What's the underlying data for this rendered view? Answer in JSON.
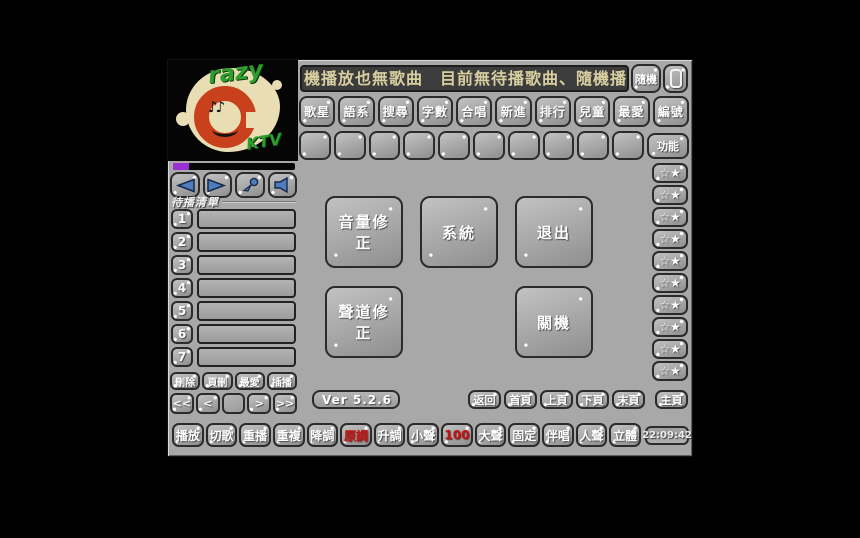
{
  "app": {
    "name": "Crazy KTV",
    "version_label": "Ver 5.2.6",
    "clock": "22:09:42"
  },
  "logo": {
    "razy": "razy",
    "ktv": "KTV",
    "notes": "♪♪"
  },
  "marquee": {
    "text": "機播放也無歌曲　目前無待播歌曲、隨機播放也無歌",
    "random_label": "隨機"
  },
  "category_buttons": [
    "歌星",
    "語系",
    "搜尋",
    "字數",
    "合唱",
    "新進",
    "排行",
    "兒童",
    "最愛",
    "編號"
  ],
  "quick_slots": {
    "function_label": "功能"
  },
  "playlist": {
    "title": "待播清單",
    "rows": [
      {
        "num": "1",
        "song": ""
      },
      {
        "num": "2",
        "song": ""
      },
      {
        "num": "3",
        "song": ""
      },
      {
        "num": "4",
        "song": ""
      },
      {
        "num": "5",
        "song": ""
      },
      {
        "num": "6",
        "song": ""
      },
      {
        "num": "7",
        "song": ""
      }
    ],
    "actions": [
      "刪除",
      "頁刪",
      "最愛",
      "插播"
    ],
    "pager": [
      "<<",
      "<",
      "",
      ">",
      ">>"
    ]
  },
  "center_buttons": [
    {
      "label": "音量修正"
    },
    {
      "label": "系統"
    },
    {
      "label": "退出"
    },
    {
      "label": "聲道修正"
    },
    {
      "label": "關機"
    }
  ],
  "favorites": {
    "star_label": "☆★"
  },
  "page_nav": [
    "返回",
    "首頁",
    "上頁",
    "下頁",
    "末頁",
    "主頁"
  ],
  "transport": [
    "播放",
    "切歌",
    "重播",
    "重複",
    "降調",
    "原調",
    "升調",
    "小聲",
    "100",
    "大聲",
    "固定",
    "伴唱",
    "人聲",
    "立體"
  ],
  "colors": {
    "window_bg": "#a8a8a8",
    "button_text": "#ffffff",
    "accent_red": "#c01414",
    "marquee_bg": "#3c3c3c",
    "marquee_text": "#d8cfa0",
    "progress_purple": "#9a2fd6",
    "icon_blue": "#4d7dba",
    "logo_red": "#c8401c",
    "logo_green": "#2f9e2f",
    "logo_cream": "#e9ddb4"
  }
}
